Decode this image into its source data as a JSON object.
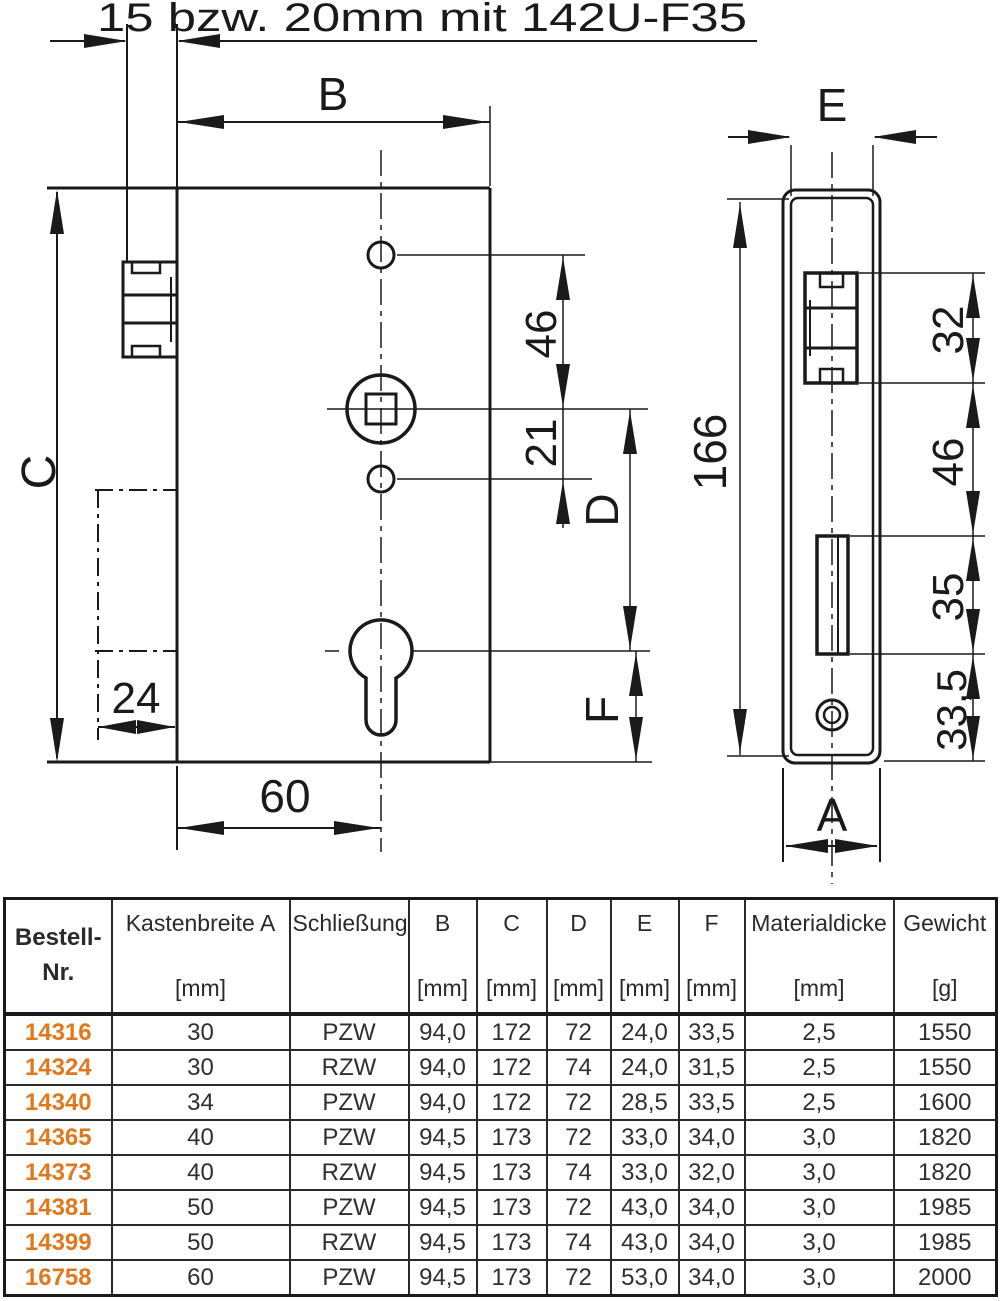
{
  "drawing": {
    "title": "15 bzw. 20mm mit 142U-F35",
    "front": {
      "b": "B",
      "c": "C",
      "n46": "46",
      "n21": "21",
      "d": "D",
      "f": "F",
      "n24": "24",
      "n60": "60"
    },
    "side": {
      "e": "E",
      "n166": "166",
      "n32": "32",
      "n46": "46",
      "n35": "35",
      "n33_5": "33,5",
      "a": "A"
    }
  },
  "colors": {
    "ink": "#1a1a1a",
    "accent_orange": "#E0781E"
  },
  "table": {
    "headers": [
      {
        "line1": "Bestell-",
        "line2": "Nr.",
        "unit": ""
      },
      {
        "line1": "Kastenbreite A",
        "line2": "",
        "unit": "[mm]"
      },
      {
        "line1": "Schließung",
        "line2": "",
        "unit": ""
      },
      {
        "line1": "B",
        "line2": "",
        "unit": "[mm]"
      },
      {
        "line1": "C",
        "line2": "",
        "unit": "[mm]"
      },
      {
        "line1": "D",
        "line2": "",
        "unit": "[mm]"
      },
      {
        "line1": "E",
        "line2": "",
        "unit": "[mm]"
      },
      {
        "line1": "F",
        "line2": "",
        "unit": "[mm]"
      },
      {
        "line1": "Materialdicke",
        "line2": "",
        "unit": "[mm]"
      },
      {
        "line1": "Gewicht",
        "line2": "",
        "unit": "[g]"
      }
    ],
    "rows": [
      [
        "14316",
        "30",
        "PZW",
        "94,0",
        "172",
        "72",
        "24,0",
        "33,5",
        "2,5",
        "1550"
      ],
      [
        "14324",
        "30",
        "RZW",
        "94,0",
        "172",
        "74",
        "24,0",
        "31,5",
        "2,5",
        "1550"
      ],
      [
        "14340",
        "34",
        "PZW",
        "94,0",
        "172",
        "72",
        "28,5",
        "33,5",
        "2,5",
        "1600"
      ],
      [
        "14365",
        "40",
        "PZW",
        "94,5",
        "173",
        "72",
        "33,0",
        "34,0",
        "3,0",
        "1820"
      ],
      [
        "14373",
        "40",
        "RZW",
        "94,5",
        "173",
        "74",
        "33,0",
        "32,0",
        "3,0",
        "1820"
      ],
      [
        "14381",
        "50",
        "PZW",
        "94,5",
        "173",
        "72",
        "43,0",
        "34,0",
        "3,0",
        "1985"
      ],
      [
        "14399",
        "50",
        "RZW",
        "94,5",
        "173",
        "74",
        "43,0",
        "34,0",
        "3,0",
        "1985"
      ],
      [
        "16758",
        "60",
        "PZW",
        "94,5",
        "173",
        "72",
        "53,0",
        "34,0",
        "3,0",
        "2000"
      ]
    ]
  }
}
